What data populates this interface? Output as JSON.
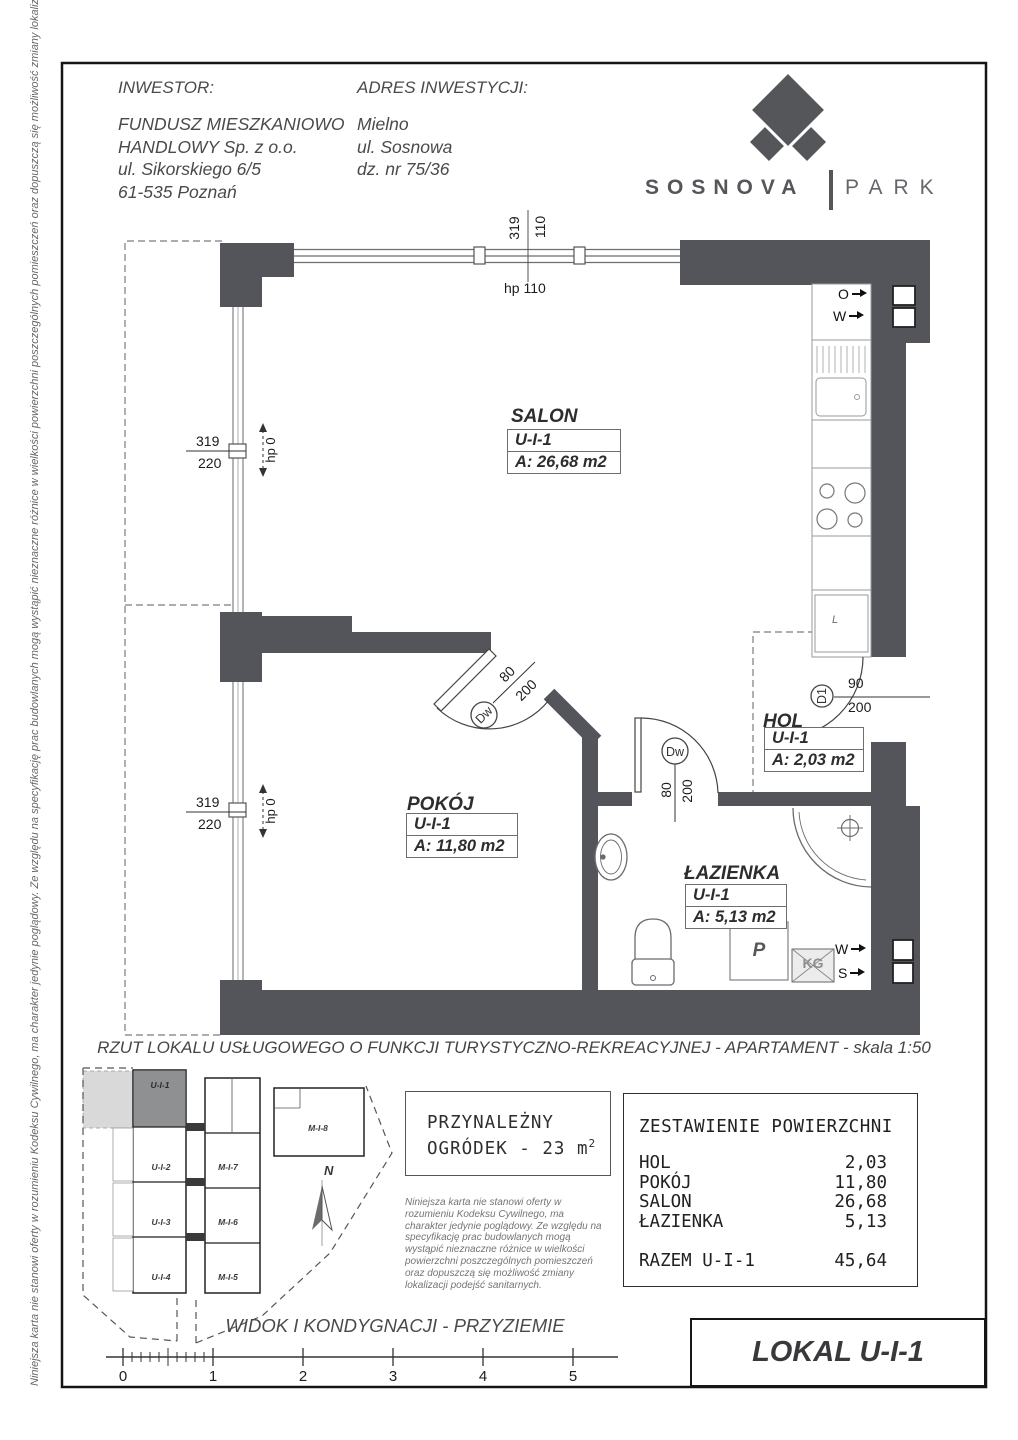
{
  "header": {
    "investor_label": "INWESTOR:",
    "investor_line1": "FUNDUSZ MIESZKANIOWO",
    "investor_line2": "HANDLOWY Sp. z o.o.",
    "investor_line3": "ul. Sikorskiego 6/5",
    "investor_line4": "61-535 Poznań",
    "address_label": "ADRES INWESTYCJI:",
    "address_line1": "Mielno",
    "address_line2": "ul. Sosnowa",
    "address_line3": "dz. nr 75/36"
  },
  "logo": {
    "brand": "SOSNOVA",
    "suffix": "PARK"
  },
  "side_note": "Niniejsza karta nie stanowi oferty w rozumieniu Kodeksu Cywilnego, ma charakter jedynie poglądowy. Ze względu na specyfikację prac budowlanych mogą wystąpić nieznaczne różnice w wielkości powierzchni poszczególnych pomieszczeń oraz dopuszczą się możliwość zmiany lokalizacji podejść sanitarnych.",
  "plan": {
    "rooms": {
      "salon": {
        "name": "SALON",
        "unit": "U-I-1",
        "area": "A: 26,68 m2"
      },
      "pokoj": {
        "name": "POKÓJ",
        "unit": "U-I-1",
        "area": "A: 11,80 m2"
      },
      "hol": {
        "name": "HOL",
        "unit": "U-I-1",
        "area": "A: 2,03 m2"
      },
      "lazienka": {
        "name": "ŁAZIENKA",
        "unit": "U-I-1",
        "area": "A: 5,13 m2"
      }
    },
    "dims": {
      "top": {
        "a": "319",
        "b": "110",
        "hp": "hp 110"
      },
      "left_upper": {
        "a": "319",
        "b": "220",
        "hp": "hp 0"
      },
      "left_lower": {
        "a": "319",
        "b": "220",
        "hp": "hp 0"
      },
      "door_pokoj": {
        "w": "80",
        "h": "200"
      },
      "door_lazienka": {
        "w": "80",
        "h": "200"
      },
      "door_d1": {
        "w": "90",
        "h": "200"
      }
    },
    "doors": {
      "interior": "Dw",
      "entry": "D1"
    },
    "marks": {
      "o": "O",
      "w": "W",
      "s": "S",
      "fridge": "L",
      "washer": "P",
      "duct": "KG"
    }
  },
  "caption": "RZUT LOKALU USŁUGOWEGO O FUNKCJI TURYSTYCZNO-REKREACYJNEJ - APARTAMENT - skala 1:50",
  "site_plan": {
    "units": {
      "u1": "U-I-1",
      "u2": "U-I-2",
      "u3": "U-I-3",
      "u4": "U-I-4",
      "m5": "M-I-5",
      "m6": "M-I-6",
      "m7": "M-I-7",
      "m8": "M-I-8"
    },
    "north": "N"
  },
  "garden": {
    "line1": "PRZYNALEŻNY",
    "line2": "OGRÓDEK - 23 m",
    "sup": "2"
  },
  "disclaimer": "Niniejsza karta nie stanowi oferty w rozumieniu Kodeksu Cywilnego, ma charakter jedynie poglądowy. Ze względu na specyfikację prac budowlanych mogą wystąpić nieznaczne różnice w wielkości powierzchni poszczególnych pomieszczeń oraz dopuszczą się możliwość zmiany lokalizacji podejść sanitarnych.",
  "area_table": {
    "title": "ZESTAWIENIE POWIERZCHNI",
    "rows": [
      {
        "label": "HOL",
        "value": "2,03"
      },
      {
        "label": "POKÓJ",
        "value": "11,80"
      },
      {
        "label": "SALON",
        "value": "26,68"
      },
      {
        "label": "ŁAZIENKA",
        "value": "5,13"
      }
    ],
    "total_label": "RAZEM U-I-1",
    "total_value": "45,64"
  },
  "view_caption": "WIDOK I KONDYGNACJI - PRZYZIEMIE",
  "scale": {
    "t0": "0",
    "t1": "1",
    "t2": "2",
    "t3": "3",
    "t4": "4",
    "t5": "5"
  },
  "unit_title": "LOKAL U-I-1"
}
